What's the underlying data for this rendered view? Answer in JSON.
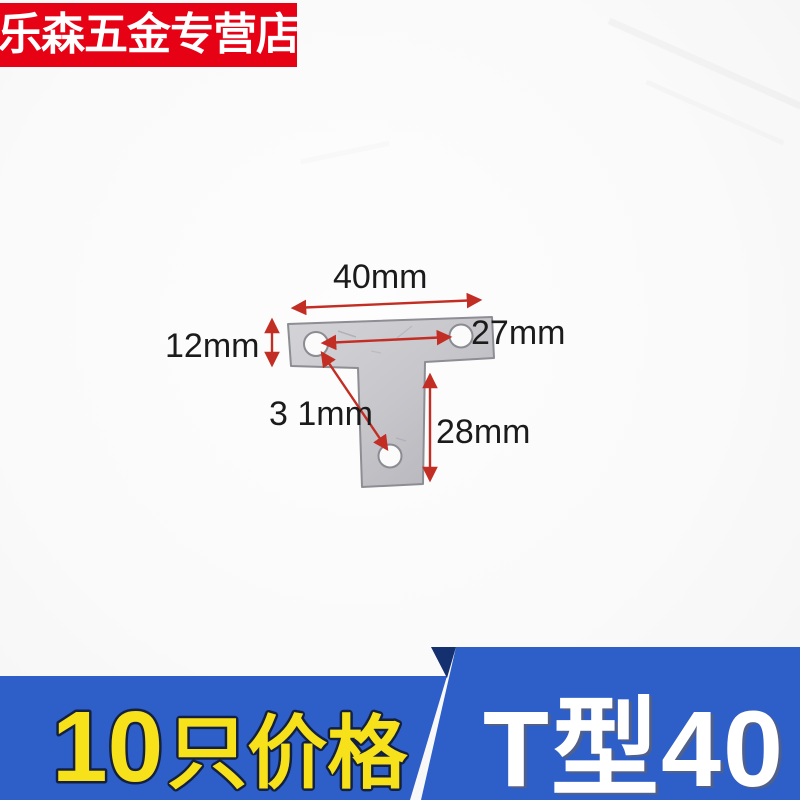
{
  "store_banner": {
    "text": "乐森五金专营店"
  },
  "diagram": {
    "product": "T-shaped flat corner bracket with three screw holes",
    "labels": {
      "top_width": "40mm",
      "left_height": "12mm",
      "hole_distance": "27mm",
      "diagonal_distance": "3 1mm",
      "stem_height": "28mm"
    }
  },
  "bottom_left_banner": {
    "number": "10",
    "suffix": "只价格"
  },
  "bottom_right_banner": {
    "label": "T型40"
  },
  "colors": {
    "banner_red": "#e60114",
    "banner_blue": "#2e5ec7",
    "banner_blue_dark": "#14306f",
    "accent_yellow": "#f6e11a",
    "arrow_red": "#c22e24",
    "plate_gray": "#c3c3c8"
  }
}
